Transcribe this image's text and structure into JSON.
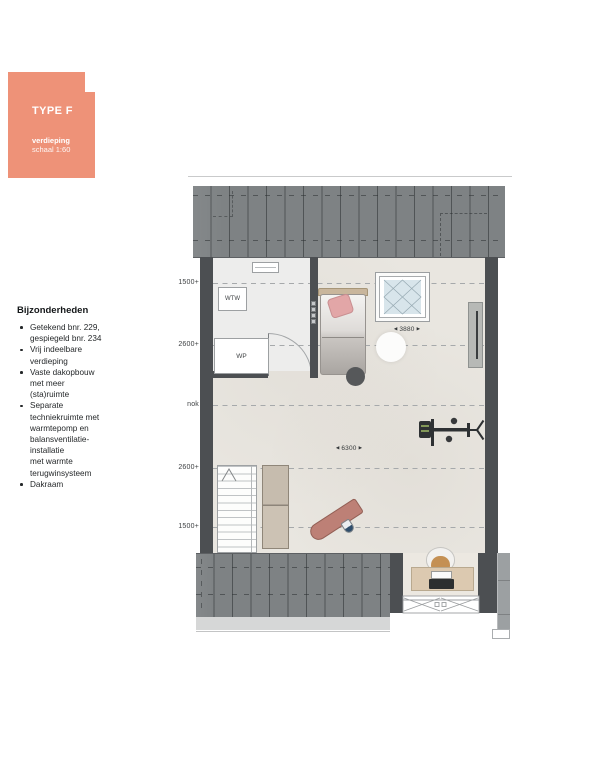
{
  "header": {
    "type_label": "TYPE F",
    "floor_label": "verdieping",
    "scale_label": "schaal 1:60"
  },
  "notes": {
    "heading": "Bijzonderheden",
    "items": [
      "Getekend bnr. 229,\ngespiegeld bnr. 234",
      "Vrij indeelbare\nverdieping",
      "Vaste dakopbouw\nmet meer\n(sta)ruimte",
      "Separate\ntechniekruimte met\nwarmtepomp en\nbalansventilatie-\ninstallatie\nmet warmte\nterugwinsysteem",
      "Dakraam"
    ]
  },
  "plan": {
    "height_labels": [
      "1500+",
      "2600+",
      "nok",
      "2600+",
      "1500+"
    ],
    "tech_room": {
      "heat_recovery_label": "WTW",
      "heat_pump_label": "WP"
    },
    "dims": {
      "skylight": {
        "arrow_left": "◀",
        "value": "3880",
        "arrow_right": "▶"
      },
      "room": {
        "arrow_left": "◀",
        "value": "6300",
        "arrow_right": "▶"
      }
    },
    "colors": {
      "accent": "#EE9278",
      "roof": "#7E8284",
      "wall": "#4C4F52",
      "floor": "#E9E6E0",
      "tech_floor": "#EDEDEC",
      "skylight_glass": "#D8E5EB",
      "pillow_pink": "#E2A6A7",
      "ironing_board_pink": "#BD8076",
      "desk_wood": "#DCC9B0",
      "cabinet_tan": "#C8BEB0"
    }
  }
}
